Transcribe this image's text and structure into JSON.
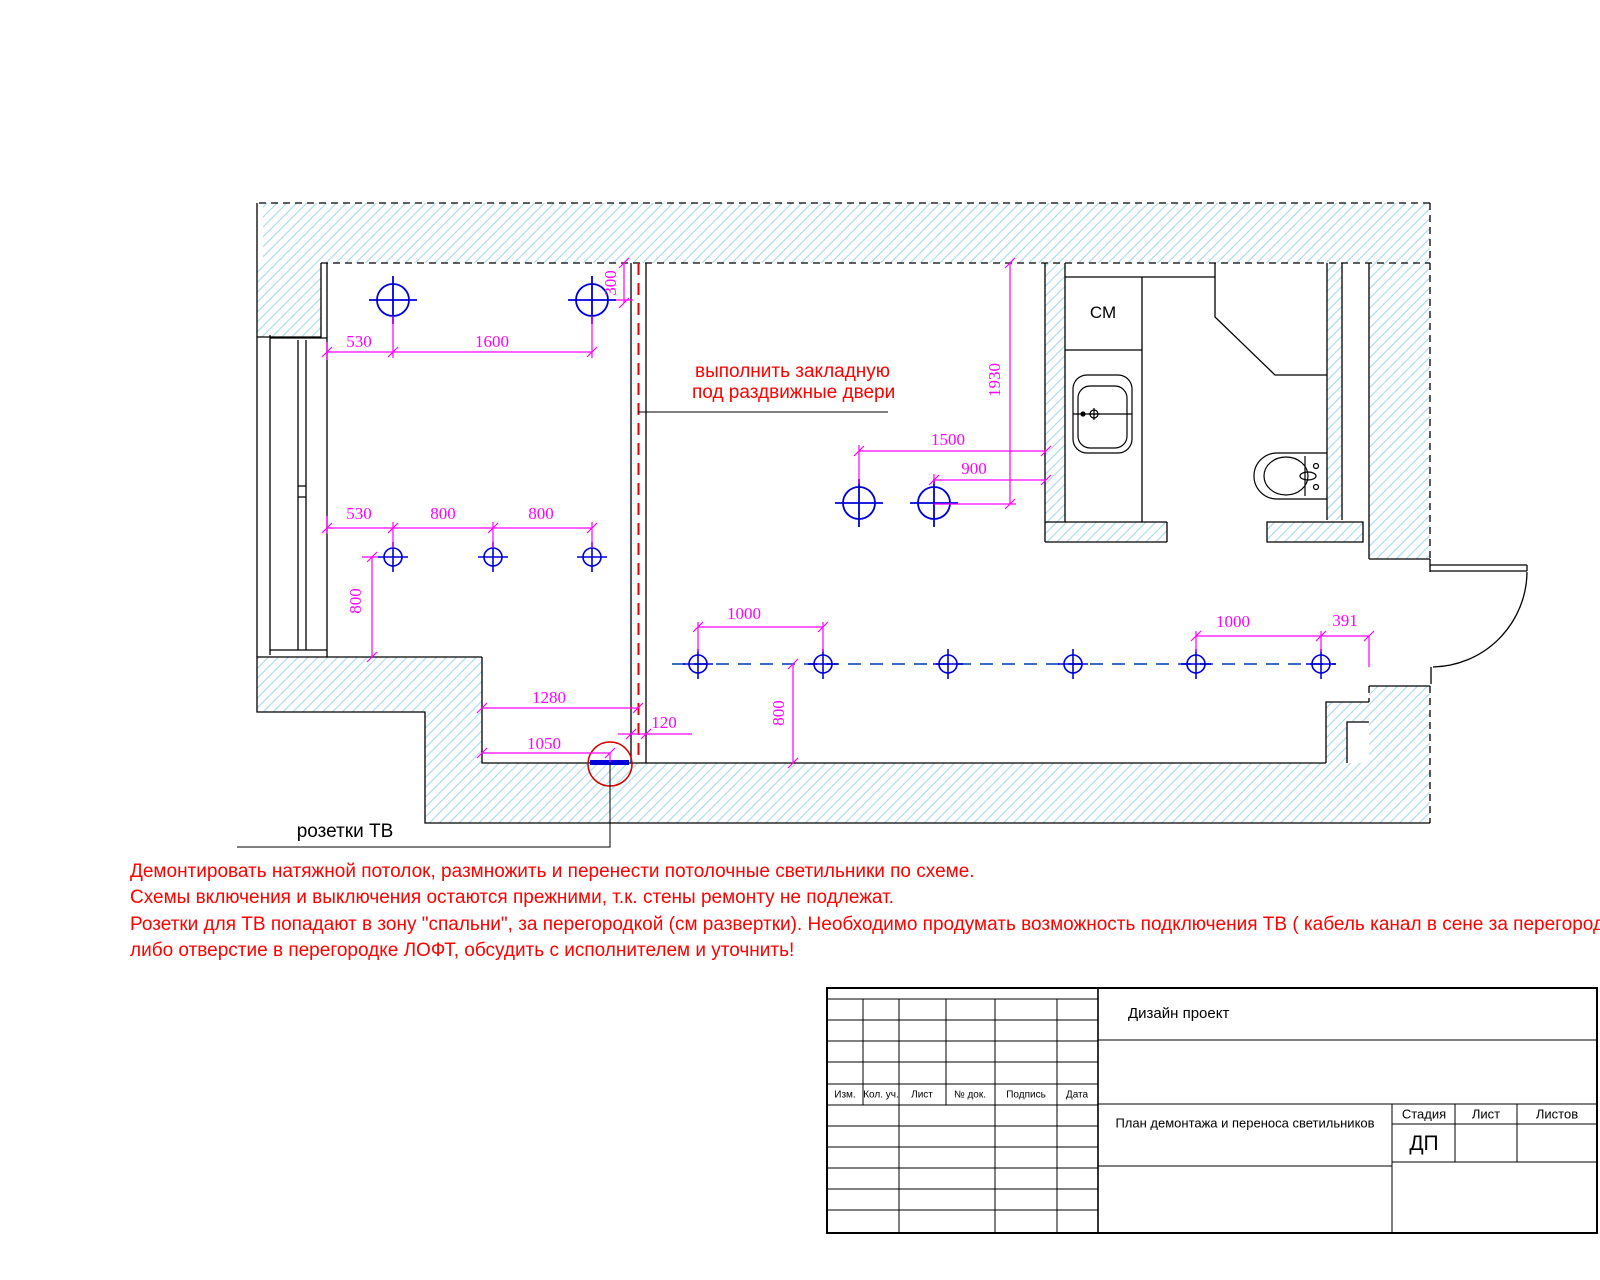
{
  "drawing": {
    "dims": {
      "a530": "530",
      "a1600": "1600",
      "a300": "300",
      "b530": "530",
      "b800a": "800",
      "b800b": "800",
      "v800_left": "800",
      "v1930": "1930",
      "h1500": "1500",
      "h900": "900",
      "h1280": "1280",
      "h1050": "1050",
      "h120": "120",
      "k1000_left": "1000",
      "v800_mid": "800",
      "k1000_right": "1000",
      "k391": "391"
    },
    "labels": {
      "cm": "СМ",
      "tv_sockets": "розетки ТВ",
      "zakladnaya_line1": "выполнить закладную",
      "zakladnaya_line2": "под раздвижные двери"
    },
    "notes": [
      "Демонтировать натяжной потолок, размножить и перенести потолочные светильники по схеме.",
      "Схемы включения и выключения остаются прежними, т.к. стены ремонту не подлежат.",
      "Розетки для ТВ попадают в зону \"спальни\", за перегородкой (см развертки). Необходимо продумать возможность подключения ТВ ( кабель канал в сене за перегородкой,",
      "либо отверстие в перегородке ЛОФТ, обсудить с исполнителем и уточнить!"
    ],
    "colors": {
      "dimension": "#ff00ff",
      "light_fixture": "#0000d9",
      "ceiling_axis": "#3a6bc5",
      "alert_red": "#ff0000",
      "wall_hatch": "#a8d8ec",
      "tv_socket": "#0000d9"
    }
  },
  "title_block": {
    "project": "Дизайн проект",
    "sheet_name": "План демонтажа и переноса светильников",
    "stage_label": "Стадия",
    "stage_value": "ДП",
    "sheet_label": "Лист",
    "sheets_label": "Листов",
    "columns": [
      "Изм.",
      "Кол. уч.",
      "Лист",
      "№ док.",
      "Подпись",
      "Дата"
    ]
  }
}
